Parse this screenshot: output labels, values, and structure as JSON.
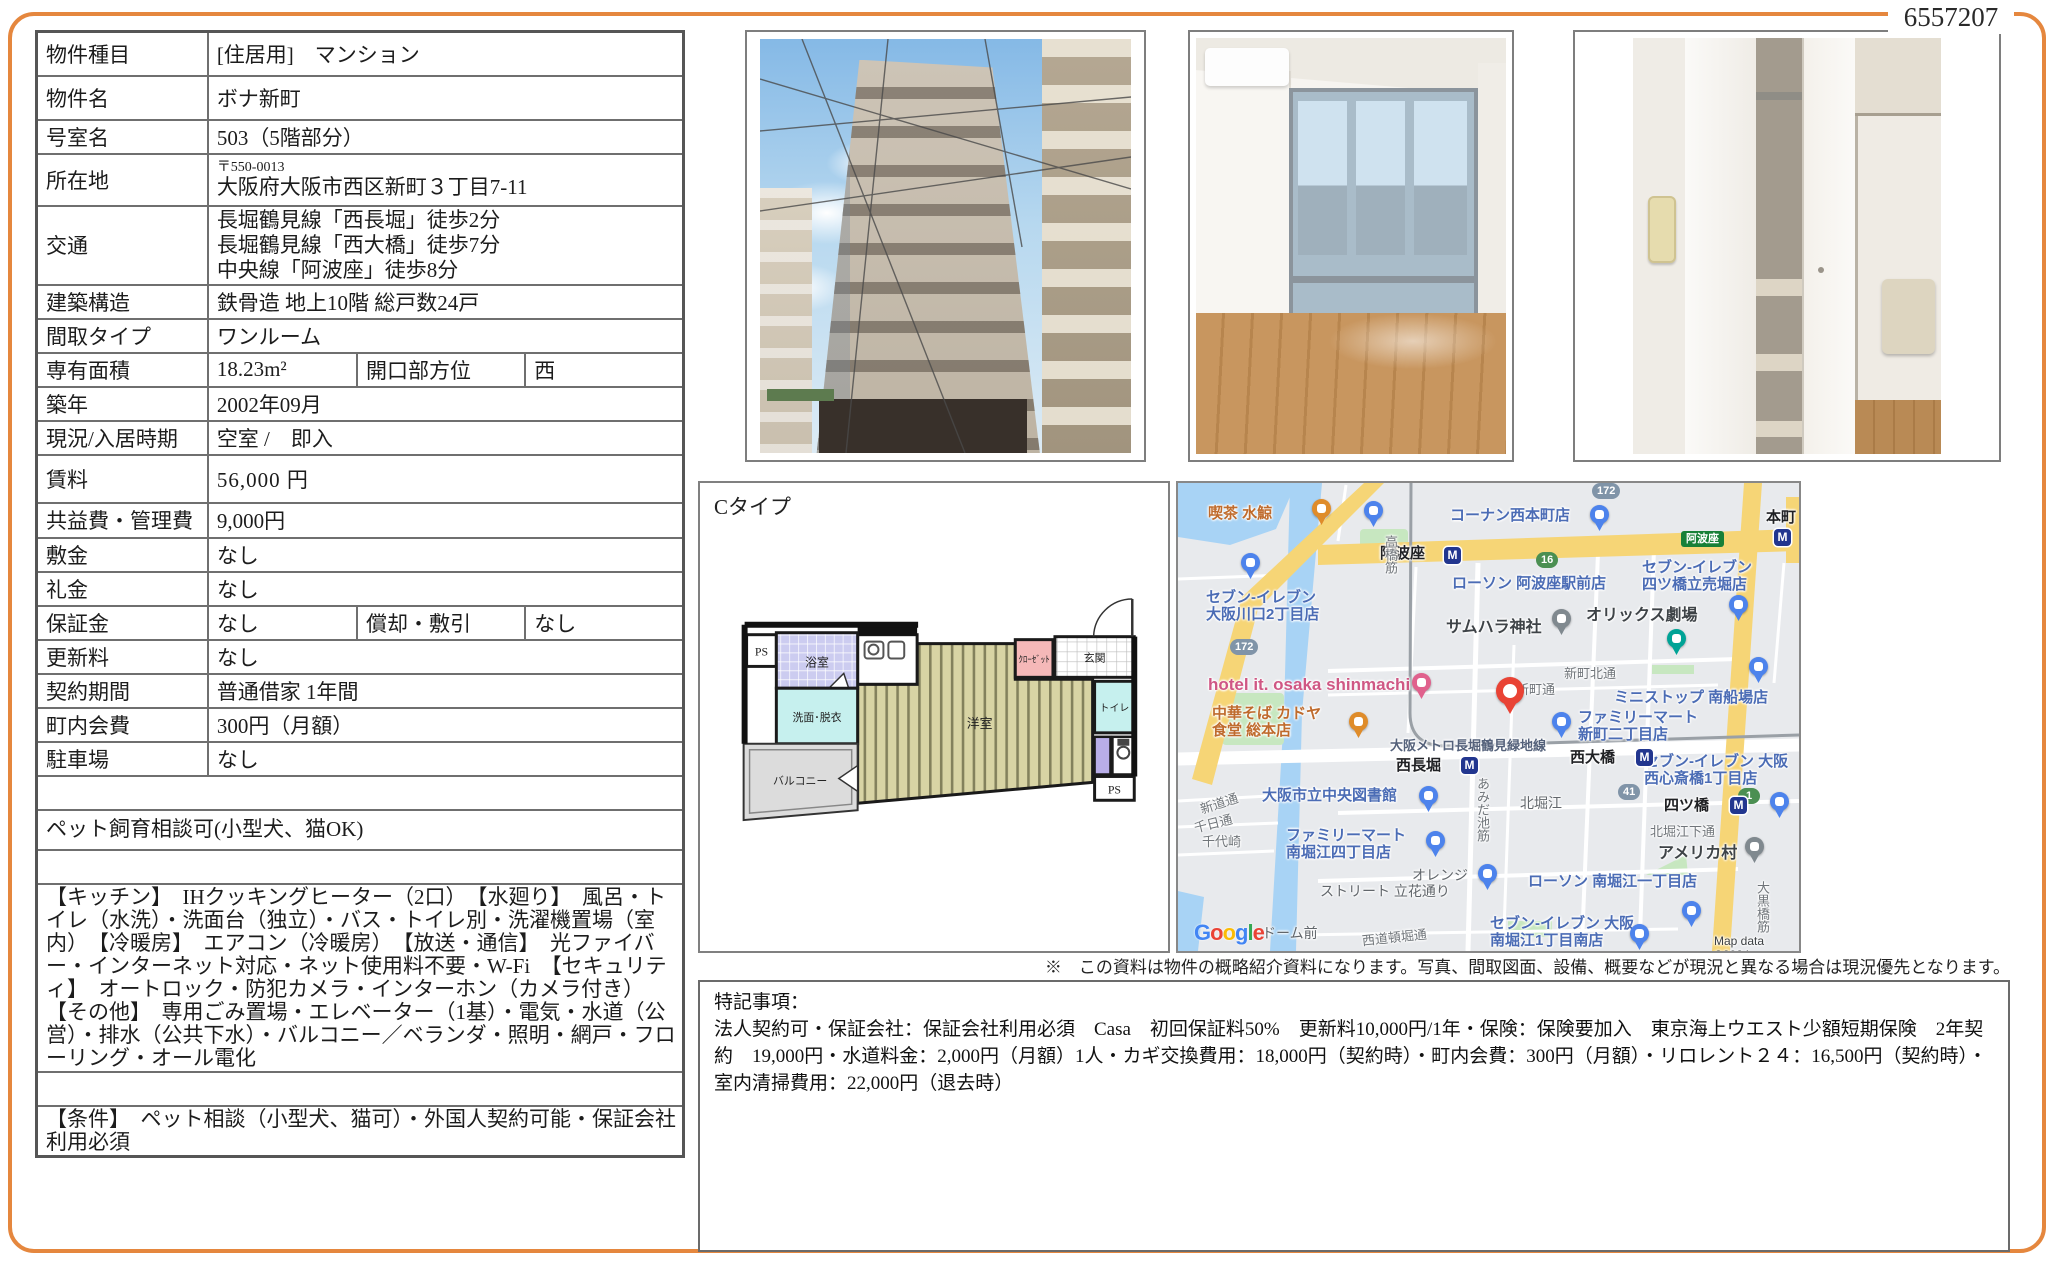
{
  "doc_number": "6557207",
  "table": [
    {
      "label": "物件種目",
      "value": "[住居用]　マンション"
    },
    {
      "label": "物件名",
      "value": "ボナ新町"
    },
    {
      "label": "号室名",
      "value": "503（5階部分）"
    },
    {
      "label": "所在地",
      "postal": "〒550-0013",
      "value": "大阪府大阪市西区新町３丁目7-11"
    },
    {
      "label": "交通",
      "lines": [
        "長堀鶴見線「西長堀」徒歩2分",
        "長堀鶴見線「西大橋」徒歩7分",
        "中央線「阿波座」徒歩8分"
      ]
    },
    {
      "label": "建築構造",
      "value": "鉄骨造 地上10階 総戸数24戸"
    },
    {
      "label": "間取タイプ",
      "value": "ワンルーム"
    },
    {
      "label": "専有面積",
      "value": "18.23m²",
      "label2": "開口部方位",
      "value2": "西"
    },
    {
      "label": "築年",
      "value": "2002年09月"
    },
    {
      "label": "現況/入居時期",
      "value": "空室 /　即入"
    },
    {
      "label": "賃料",
      "value": "56,000 円"
    },
    {
      "label": "共益費・管理費",
      "value": "9,000円"
    },
    {
      "label": "敷金",
      "value": "なし"
    },
    {
      "label": "礼金",
      "value": "なし"
    },
    {
      "label": "保証金",
      "value": "なし",
      "label2": "償却・敷引",
      "value2": "なし"
    },
    {
      "label": "更新料",
      "value": "なし"
    },
    {
      "label": "契約期間",
      "value": "普通借家 1年間"
    },
    {
      "label": "町内会費",
      "value": "300円（月額）"
    },
    {
      "label": "駐車場",
      "value": "なし"
    }
  ],
  "sections": {
    "bikou_h": "備　考",
    "bikou": "ペット飼育相談可(小型犬、猫OK)",
    "setsubi_h": "設　備",
    "setsubi": "【キッチン】　IHクッキングヒーター（2口）　【水廻り】　風呂・トイレ（水洗）・洗面台（独立）・バス・トイレ別・洗濯機置場（室内）　【冷暖房】　エアコン（冷暖房）　【放送・通信】　光ファイバー・インターネット対応・ネット使用料不要・W-Fi　【セキュリティ】　オートロック・防犯カメラ・インターホン（カメラ付き）　【その他】　専用ごみ置場・エレベーター（1基）・電気・水道（公営）・排水（公共下水）・バルコニー／ベランダ・照明・網戸・フローリング・オール電化",
    "jouken_h": "条　件",
    "jouken": "【条件】　ペット相談（小型犬、猫可）・外国人契約可能・保証会社利用必須"
  },
  "floorplan": {
    "type_label": "Cタイプ",
    "rooms": [
      "PS",
      "浴室",
      "洗面･脱衣",
      "バルコニー",
      "洋室",
      "ｸﾛｰｾﾞｯﾄ",
      "玄関",
      "トイレ",
      "PS"
    ]
  },
  "map": {
    "metro": "M",
    "google": "Google",
    "labels": [
      {
        "t": "喫茶 水鯨",
        "x": 30,
        "y": 22,
        "c": "po"
      },
      {
        "t": "コーナン西本町店",
        "x": 272,
        "y": 24,
        "c": "pb"
      },
      {
        "t": "阿波座",
        "x": 202,
        "y": 62,
        "c": "st"
      },
      {
        "t": "本町",
        "x": 588,
        "y": 26,
        "c": "st"
      },
      {
        "t": "ローソン 阿波座駅前店",
        "x": 274,
        "y": 92,
        "c": "pb"
      },
      {
        "t": "セブン-イレブン\n大阪川口2丁目店",
        "x": 28,
        "y": 106,
        "c": "pb"
      },
      {
        "t": "セブン-イレブン\n四ツ橋立売堀店",
        "x": 464,
        "y": 76,
        "c": "pb"
      },
      {
        "t": "サムハラ神社",
        "x": 268,
        "y": 136,
        "c": "pd"
      },
      {
        "t": "オリックス劇場",
        "x": 408,
        "y": 124,
        "c": "pd"
      },
      {
        "t": "hotel it. osaka shinmachi",
        "x": 30,
        "y": 192,
        "c": "pp"
      },
      {
        "t": "中華そば カドヤ\n食堂 総本店",
        "x": 34,
        "y": 222,
        "c": "po"
      },
      {
        "t": "ミニストップ 南船場店",
        "x": 436,
        "y": 206,
        "c": "pb"
      },
      {
        "t": "ファミリーマート\n新町二丁目店",
        "x": 400,
        "y": 226,
        "c": "pb"
      },
      {
        "t": "新町北通",
        "x": 386,
        "y": 184,
        "c": "sn"
      },
      {
        "t": "新町通",
        "x": 338,
        "y": 200,
        "c": "sn"
      },
      {
        "t": "大阪メトロ長堀鶴見緑地線",
        "x": 212,
        "y": 256,
        "c": "rl"
      },
      {
        "t": "西長堀",
        "x": 218,
        "y": 274,
        "c": "st"
      },
      {
        "t": "西大橋",
        "x": 392,
        "y": 266,
        "c": "st"
      },
      {
        "t": "セブン-イレブン 大阪\n西心斎橋1丁目店",
        "x": 466,
        "y": 270,
        "c": "pb"
      },
      {
        "t": "大阪市立中央図書館",
        "x": 84,
        "y": 304,
        "c": "pb"
      },
      {
        "t": "北堀江",
        "x": 342,
        "y": 312,
        "c": "sn2"
      },
      {
        "t": "四ツ橋",
        "x": 486,
        "y": 314,
        "c": "st"
      },
      {
        "t": "北堀江下通",
        "x": 472,
        "y": 342,
        "c": "sn"
      },
      {
        "t": "ファミリーマート\n南堀江四丁目店",
        "x": 108,
        "y": 344,
        "c": "pb"
      },
      {
        "t": "アメリカ村",
        "x": 480,
        "y": 362,
        "c": "pd"
      },
      {
        "t": "オレンジ",
        "x": 234,
        "y": 384,
        "c": "sn2"
      },
      {
        "t": "ストリート 立花通り",
        "x": 142,
        "y": 400,
        "c": "sn2"
      },
      {
        "t": "ローソン 南堀江一丁目店",
        "x": 350,
        "y": 390,
        "c": "pb"
      },
      {
        "t": "セブン-イレブン 大阪\n南堀江1丁目南店",
        "x": 312,
        "y": 432,
        "c": "pb"
      },
      {
        "t": "新道通",
        "x": 22,
        "y": 314,
        "c": "sn",
        "r": -18
      },
      {
        "t": "千日通",
        "x": 16,
        "y": 334,
        "c": "sn",
        "r": -14
      },
      {
        "t": "千代崎",
        "x": 24,
        "y": 352,
        "c": "sn"
      },
      {
        "t": "西道頓堀通",
        "x": 184,
        "y": 448,
        "c": "sn",
        "r": -6
      },
      {
        "t": "ドーム前",
        "x": 84,
        "y": 442,
        "c": "sn2"
      },
      {
        "t": "あみだ池筋",
        "x": 296,
        "y": 294,
        "c": "sn",
        "v": 1
      },
      {
        "t": "大黒橋筋",
        "x": 576,
        "y": 398,
        "c": "sn",
        "v": 1
      },
      {
        "t": "高橋筋",
        "x": 204,
        "y": 52,
        "c": "sn",
        "v": 1
      },
      {
        "t": "Map data ©2024",
        "x": 536,
        "y": 452,
        "c": "cp"
      }
    ],
    "markers": [
      {
        "x": 134,
        "y": 16,
        "t": "cafe"
      },
      {
        "x": 186,
        "y": 18,
        "t": "store"
      },
      {
        "x": 412,
        "y": 22,
        "t": "shop"
      },
      {
        "x": 63,
        "y": 70,
        "t": "store"
      },
      {
        "x": 551,
        "y": 112,
        "t": "store"
      },
      {
        "x": 374,
        "y": 126,
        "t": "shrine"
      },
      {
        "x": 489,
        "y": 146,
        "t": "theater"
      },
      {
        "x": 234,
        "y": 190,
        "t": "hotel"
      },
      {
        "x": 171,
        "y": 229,
        "t": "rest"
      },
      {
        "x": 571,
        "y": 174,
        "t": "store"
      },
      {
        "x": 374,
        "y": 229,
        "t": "store"
      },
      {
        "x": 241,
        "y": 303,
        "t": "lib"
      },
      {
        "x": 248,
        "y": 348,
        "t": "store"
      },
      {
        "x": 592,
        "y": 309,
        "t": "store"
      },
      {
        "x": 567,
        "y": 354,
        "t": "attr"
      },
      {
        "x": 300,
        "y": 381,
        "t": "store"
      },
      {
        "x": 504,
        "y": 418,
        "t": "store"
      },
      {
        "x": 452,
        "y": 441,
        "t": "store"
      },
      {
        "x": 318,
        "y": 194,
        "t": "dest"
      },
      {
        "x": 266,
        "y": 64,
        "t": "metro"
      },
      {
        "x": 596,
        "y": 46,
        "t": "metro"
      },
      {
        "x": 283,
        "y": 274,
        "t": "metro"
      },
      {
        "x": 458,
        "y": 266,
        "t": "metro"
      },
      {
        "x": 552,
        "y": 314,
        "t": "metro"
      }
    ],
    "badges": [
      {
        "t": "172",
        "x": 52,
        "y": 156,
        "c": "bb"
      },
      {
        "t": "172",
        "x": 414,
        "y": 0,
        "c": "bb"
      },
      {
        "t": "16",
        "x": 358,
        "y": 69,
        "c": "bg"
      },
      {
        "t": "41",
        "x": 440,
        "y": 301,
        "c": "bb"
      },
      {
        "t": "1",
        "x": 560,
        "y": 305,
        "c": "bg"
      },
      {
        "t": "阿波座",
        "x": 503,
        "y": 48,
        "c": "br"
      }
    ]
  },
  "notes": {
    "disclaimer": "※　この資料は物件の概略紹介資料になります。写真、間取図面、設備、概要などが現況と異なる場合は現況優先となります。",
    "special_title": "特記事項：",
    "special_body": "法人契約可・保証会社：保証会社利用必須　Casa　初回保証料50%　更新料10,000円/1年・保険：保険要加入　東京海上ウエスト少額短期保険　2年契約　19,000円・水道料金：2,000円（月額）1人・カギ交換費用：18,000円（契約時）・町内会費：300円（月額）・リロレント２４：16,500円（契約時）・室内清掃費用：22,000円（退去時）"
  }
}
